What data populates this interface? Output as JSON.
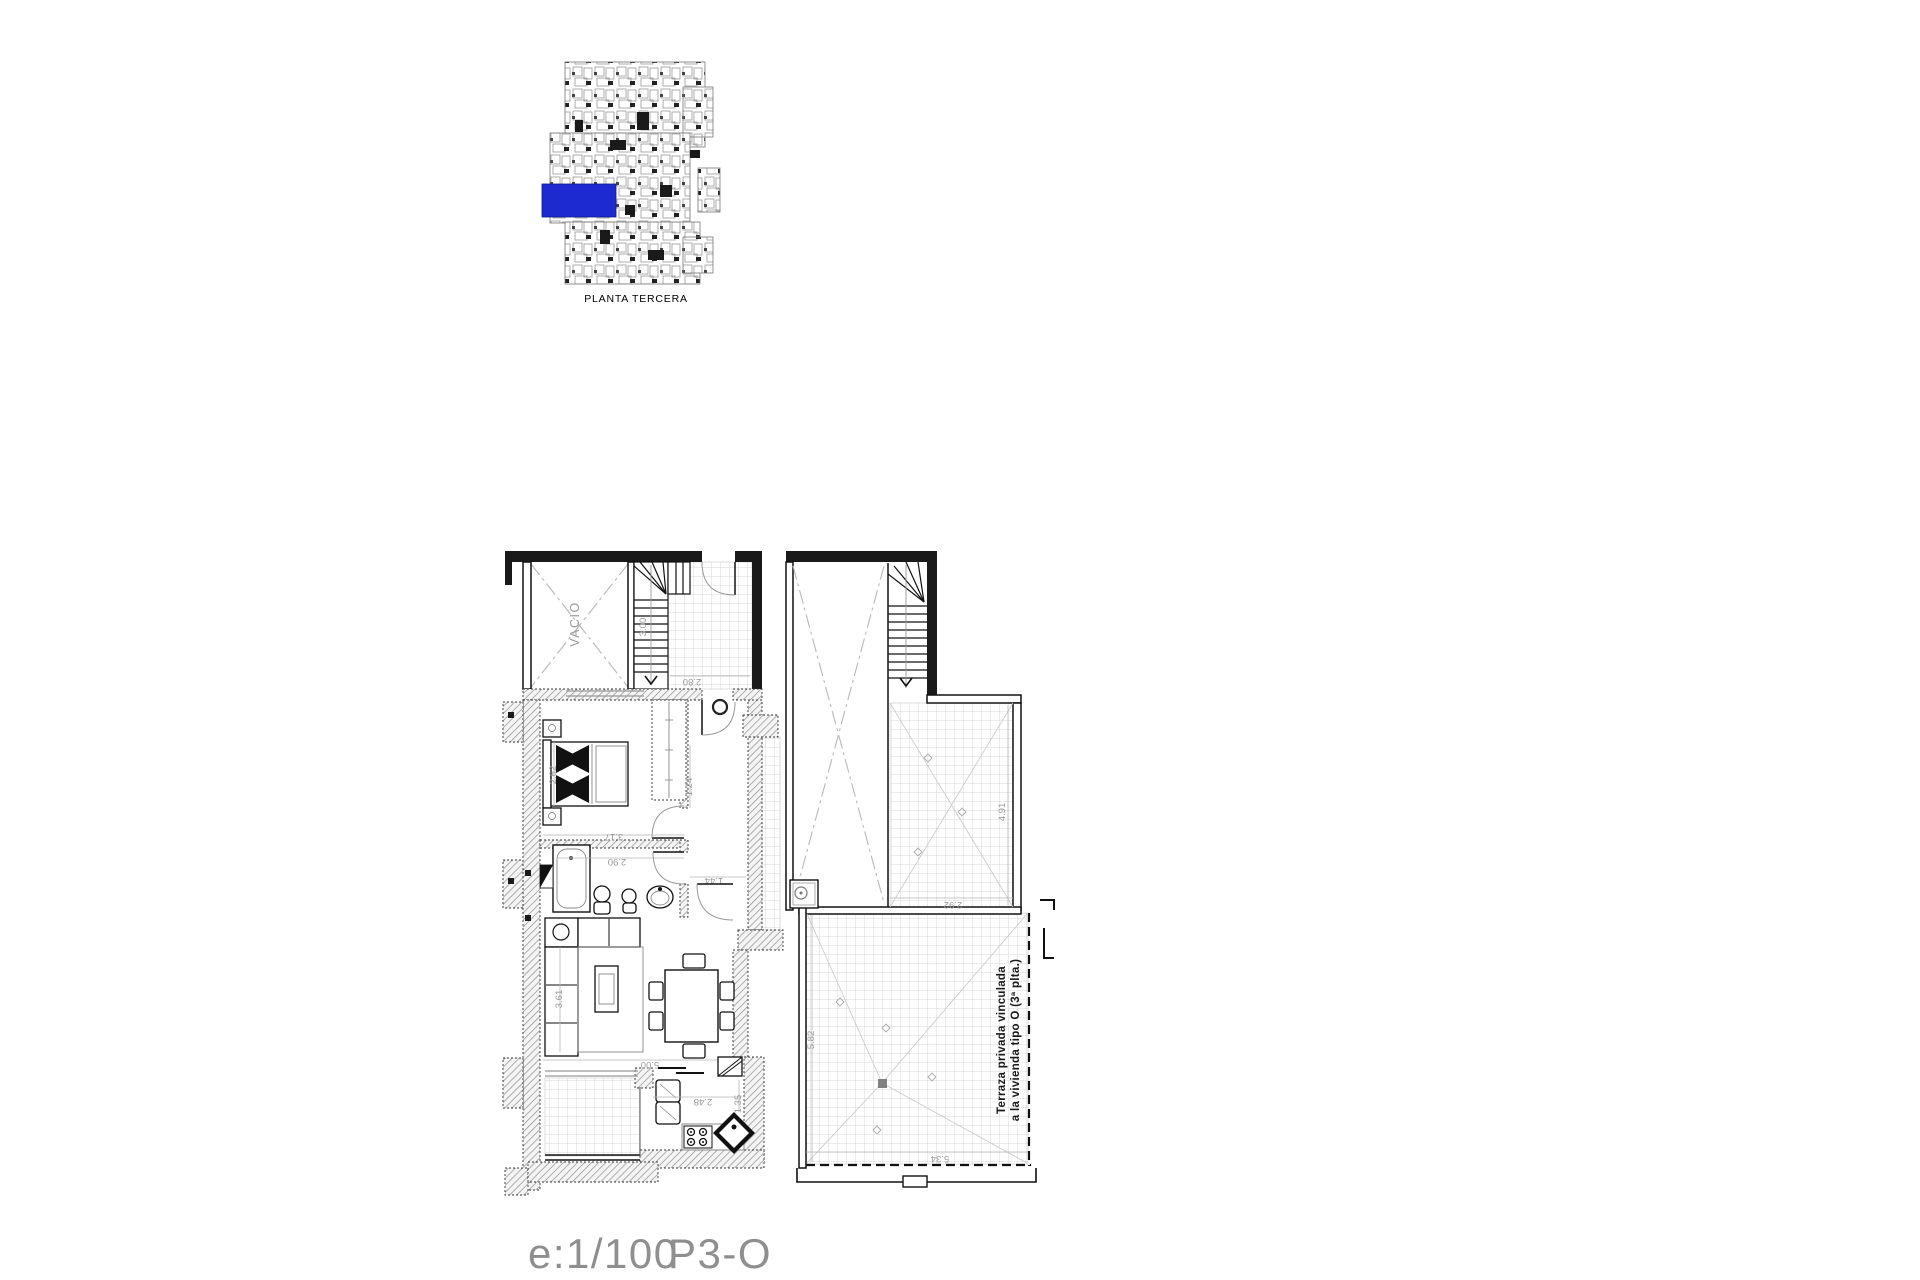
{
  "key_plan": {
    "name": "PLANTA TERCERA",
    "highlight_color": "#1c2ad0"
  },
  "title_block": {
    "scale": "e:1/100",
    "plan_code": "P3-O"
  },
  "plan": {
    "labels": {
      "void": "VACIO",
      "terrace_note_line1": "Terraza privada vinculada",
      "terrace_note_line2": "a la vivienda tipo O (3ª plta.)"
    },
    "dimensions": {
      "stair_run": "3.00",
      "entry_terrace": "2.80",
      "bedroom_width": "3.17",
      "bedroom_depth": "2.62",
      "bathroom_width": "2.90",
      "hall_width": "1.44",
      "corridor_width": "1.24",
      "living_width": "5.00",
      "living_depth": "3.61",
      "kitchen_width": "2.48",
      "kitchen_depth": "1.35",
      "upper_terrace_depth": "4.91",
      "upper_terrace_width": "2.92",
      "main_terrace_depth": "5.82",
      "main_terrace_width": "5.34"
    }
  }
}
